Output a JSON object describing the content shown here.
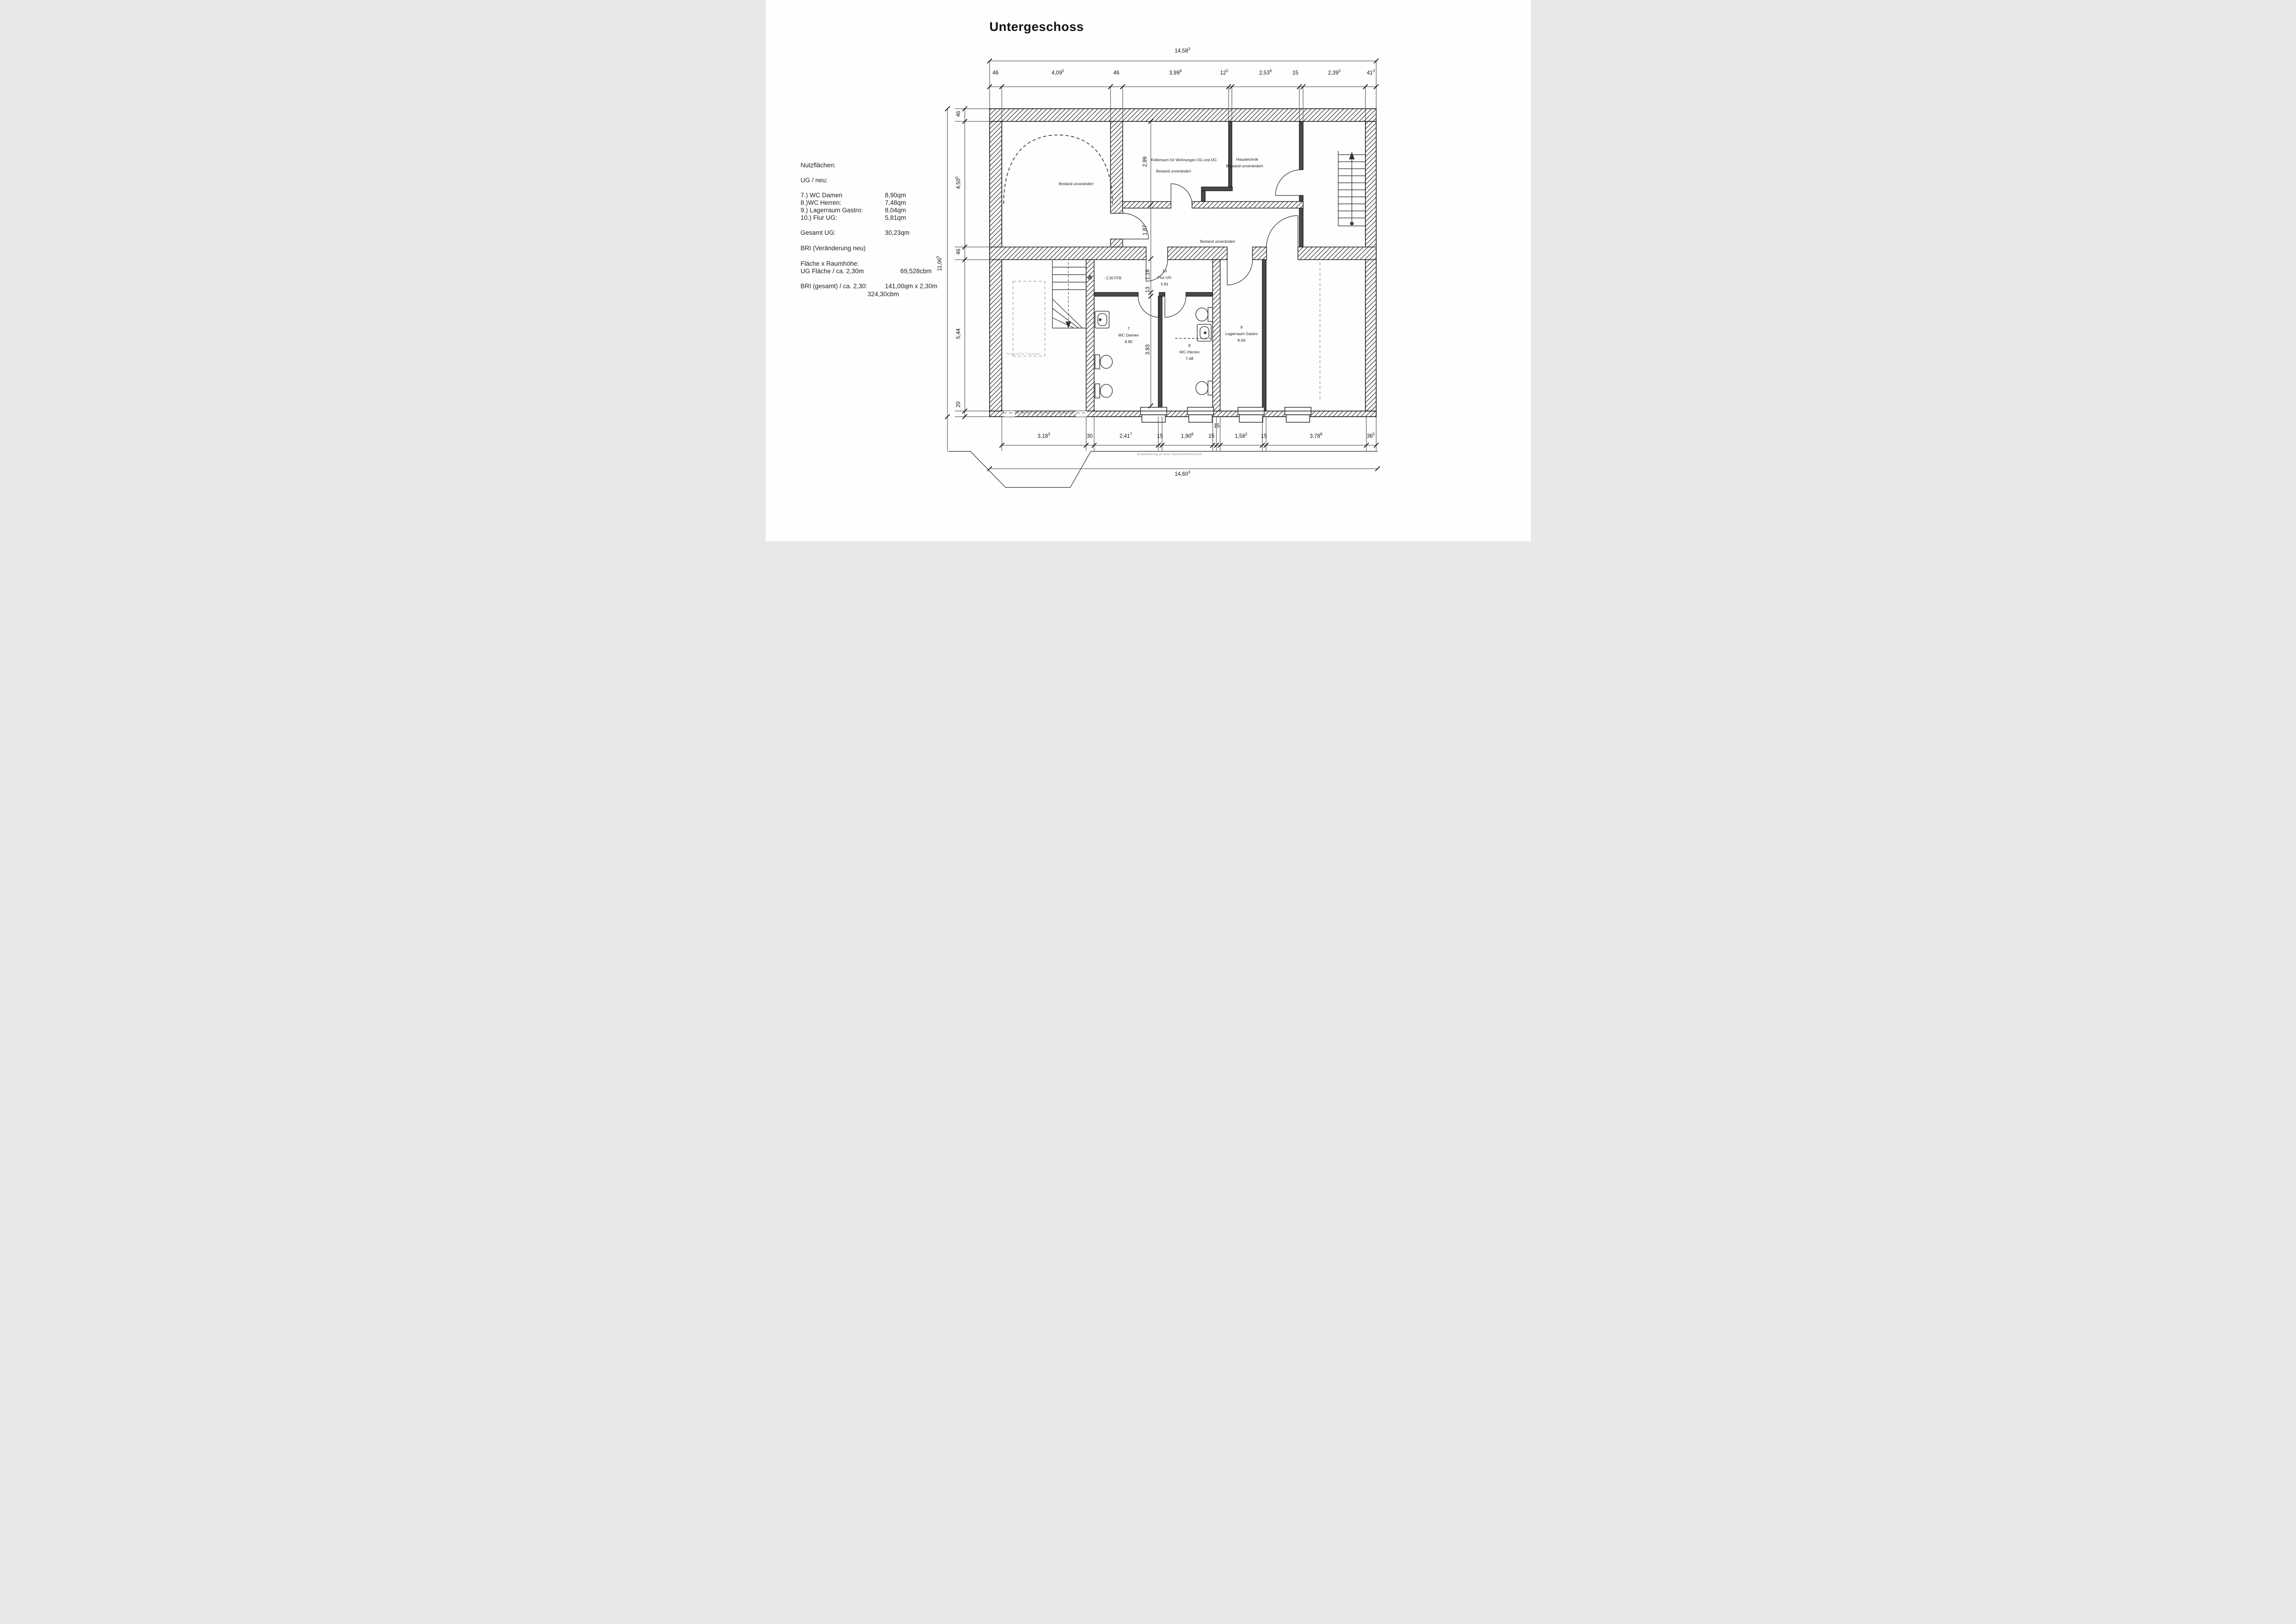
{
  "title": "Untergeschoss",
  "notes": {
    "heading": "Nutzflächen:",
    "subheading": "UG / neu:",
    "items": [
      {
        "label": "7.) WC Damen",
        "value": "8,90qm"
      },
      {
        "label": "8.)WC Herren:",
        "value": "7,48qm"
      },
      {
        "label": "9.) Lagerraum Gastro:",
        "value": "8,04qm"
      },
      {
        "label": "10.) Flur UG:",
        "value": "5,81qm"
      }
    ],
    "total_label": "Gesamt UG:",
    "total_value": "30,23qm",
    "bri_label": "BRI (Veränderung neu)",
    "flaeche_label": "Fläche x Raumhöhe:",
    "ug_flaeche_label": "UG Fläche / ca. 2,30m",
    "ug_flaeche_value": "69,528cbm",
    "bri_gesamt_label": "BRI (gesamt) / ca. 2,30:",
    "bri_gesamt_value": "141,00qm x 2,30m",
    "bri_gesamt_value2": "324,30cbm"
  },
  "dims": {
    "top_overall": {
      "v": "14,58",
      "s": "3"
    },
    "top": [
      {
        "v": "46"
      },
      {
        "v": "4,09",
        "s": "5"
      },
      {
        "v": "46"
      },
      {
        "v": "3,99",
        "s": "8"
      },
      {
        "v": "12",
        "s": "5"
      },
      {
        "v": "2,53",
        "s": "8"
      },
      {
        "v": "15"
      },
      {
        "v": "2,39",
        "s": "3"
      },
      {
        "v": "41",
        "s": "3"
      }
    ],
    "left_overall": {
      "v": "11,06",
      "s": "5"
    },
    "left": [
      {
        "v": "46"
      },
      {
        "v": "4,50",
        "s": "5"
      },
      {
        "v": "46"
      },
      {
        "v": "5,44"
      },
      {
        "v": "20"
      }
    ],
    "bottom_overall": {
      "v": "14,60",
      "s": "3"
    },
    "bottom": [
      {
        "v": "3,18",
        "s": "3"
      },
      {
        "v": "30"
      },
      {
        "v": "2,41",
        "s": "7"
      },
      {
        "v": "15"
      },
      {
        "v": "1,90",
        "s": "8"
      },
      {
        "v": "15"
      },
      {
        "v": "15"
      },
      {
        "v": "1,58",
        "s": "2"
      },
      {
        "v": "15"
      },
      {
        "v": "3,78",
        "s": "8"
      },
      {
        "v": "36",
        "s": "5"
      }
    ],
    "interior": [
      {
        "v": "2,99"
      },
      {
        "v": "1,87"
      },
      {
        "v": "1,18"
      },
      {
        "v": "13"
      },
      {
        "v": "3,93"
      }
    ]
  },
  "rooms": {
    "bestand_tl": "Bestand unverändert",
    "kellerraum_l1": "Kellerraum  für Wohnungen  OG und DG",
    "kellerraum_l2": "Bestand unverändert",
    "haustechnik_l1": "Haustechnik",
    "haustechnik_l2": "Bestand unverändert",
    "mitte": "Bestand unverändert",
    "flur": {
      "no": "10",
      "name": "Flur UG",
      "area": "5.81"
    },
    "wc_damen": {
      "no": "7",
      "name": "WC Damen",
      "area": "8.90"
    },
    "wc_herren": {
      "no": "8",
      "name": "WC-Herren",
      "area": "7.48"
    },
    "lager": {
      "no": "9",
      "name": "Lagerraum  Gastro",
      "area": "8.04"
    }
  },
  "annotations": {
    "ffb": "- 2,30 FFB",
    "fundament": "Fundament für Treppenlauf",
    "drain": "Entwässerung an best. Hauskontrollschacht"
  }
}
